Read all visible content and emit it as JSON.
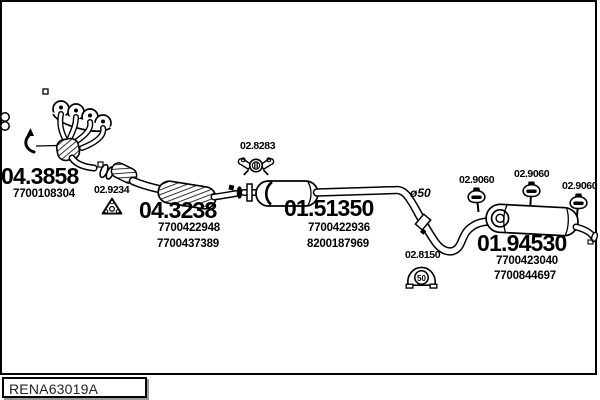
{
  "figure": {
    "type": "exhaust-system-parts-diagram",
    "drawing_ref": "RENA63019A"
  },
  "labels": {
    "manifold_code": "04.3858",
    "manifold_pn1": "7700108304",
    "gasket_code": "02.9234",
    "catalyst_code": "04.3238",
    "catalyst_pn1": "7700422948",
    "catalyst_pn2": "7700437389",
    "clamp_a_code": "02.8283",
    "mid_muffler_code": "01.51350",
    "mid_muffler_pn1": "7700422936",
    "mid_muffler_pn2": "8200187969",
    "pipe_diameter": "ø50",
    "clamp_b_code": "02.8150",
    "clamp_b_size": "50",
    "hanger1_code": "02.9060",
    "hanger2_code": "02.9060",
    "hanger3_code": "02.9060",
    "rear_muffler_code": "01.94530",
    "rear_muffler_pn1": "7700423040",
    "rear_muffler_pn2": "7700844697",
    "drawing_ref": "RENA63019A"
  },
  "colors": {
    "line": "#000000",
    "background": "#ffffff",
    "ref_text": "#222222"
  }
}
